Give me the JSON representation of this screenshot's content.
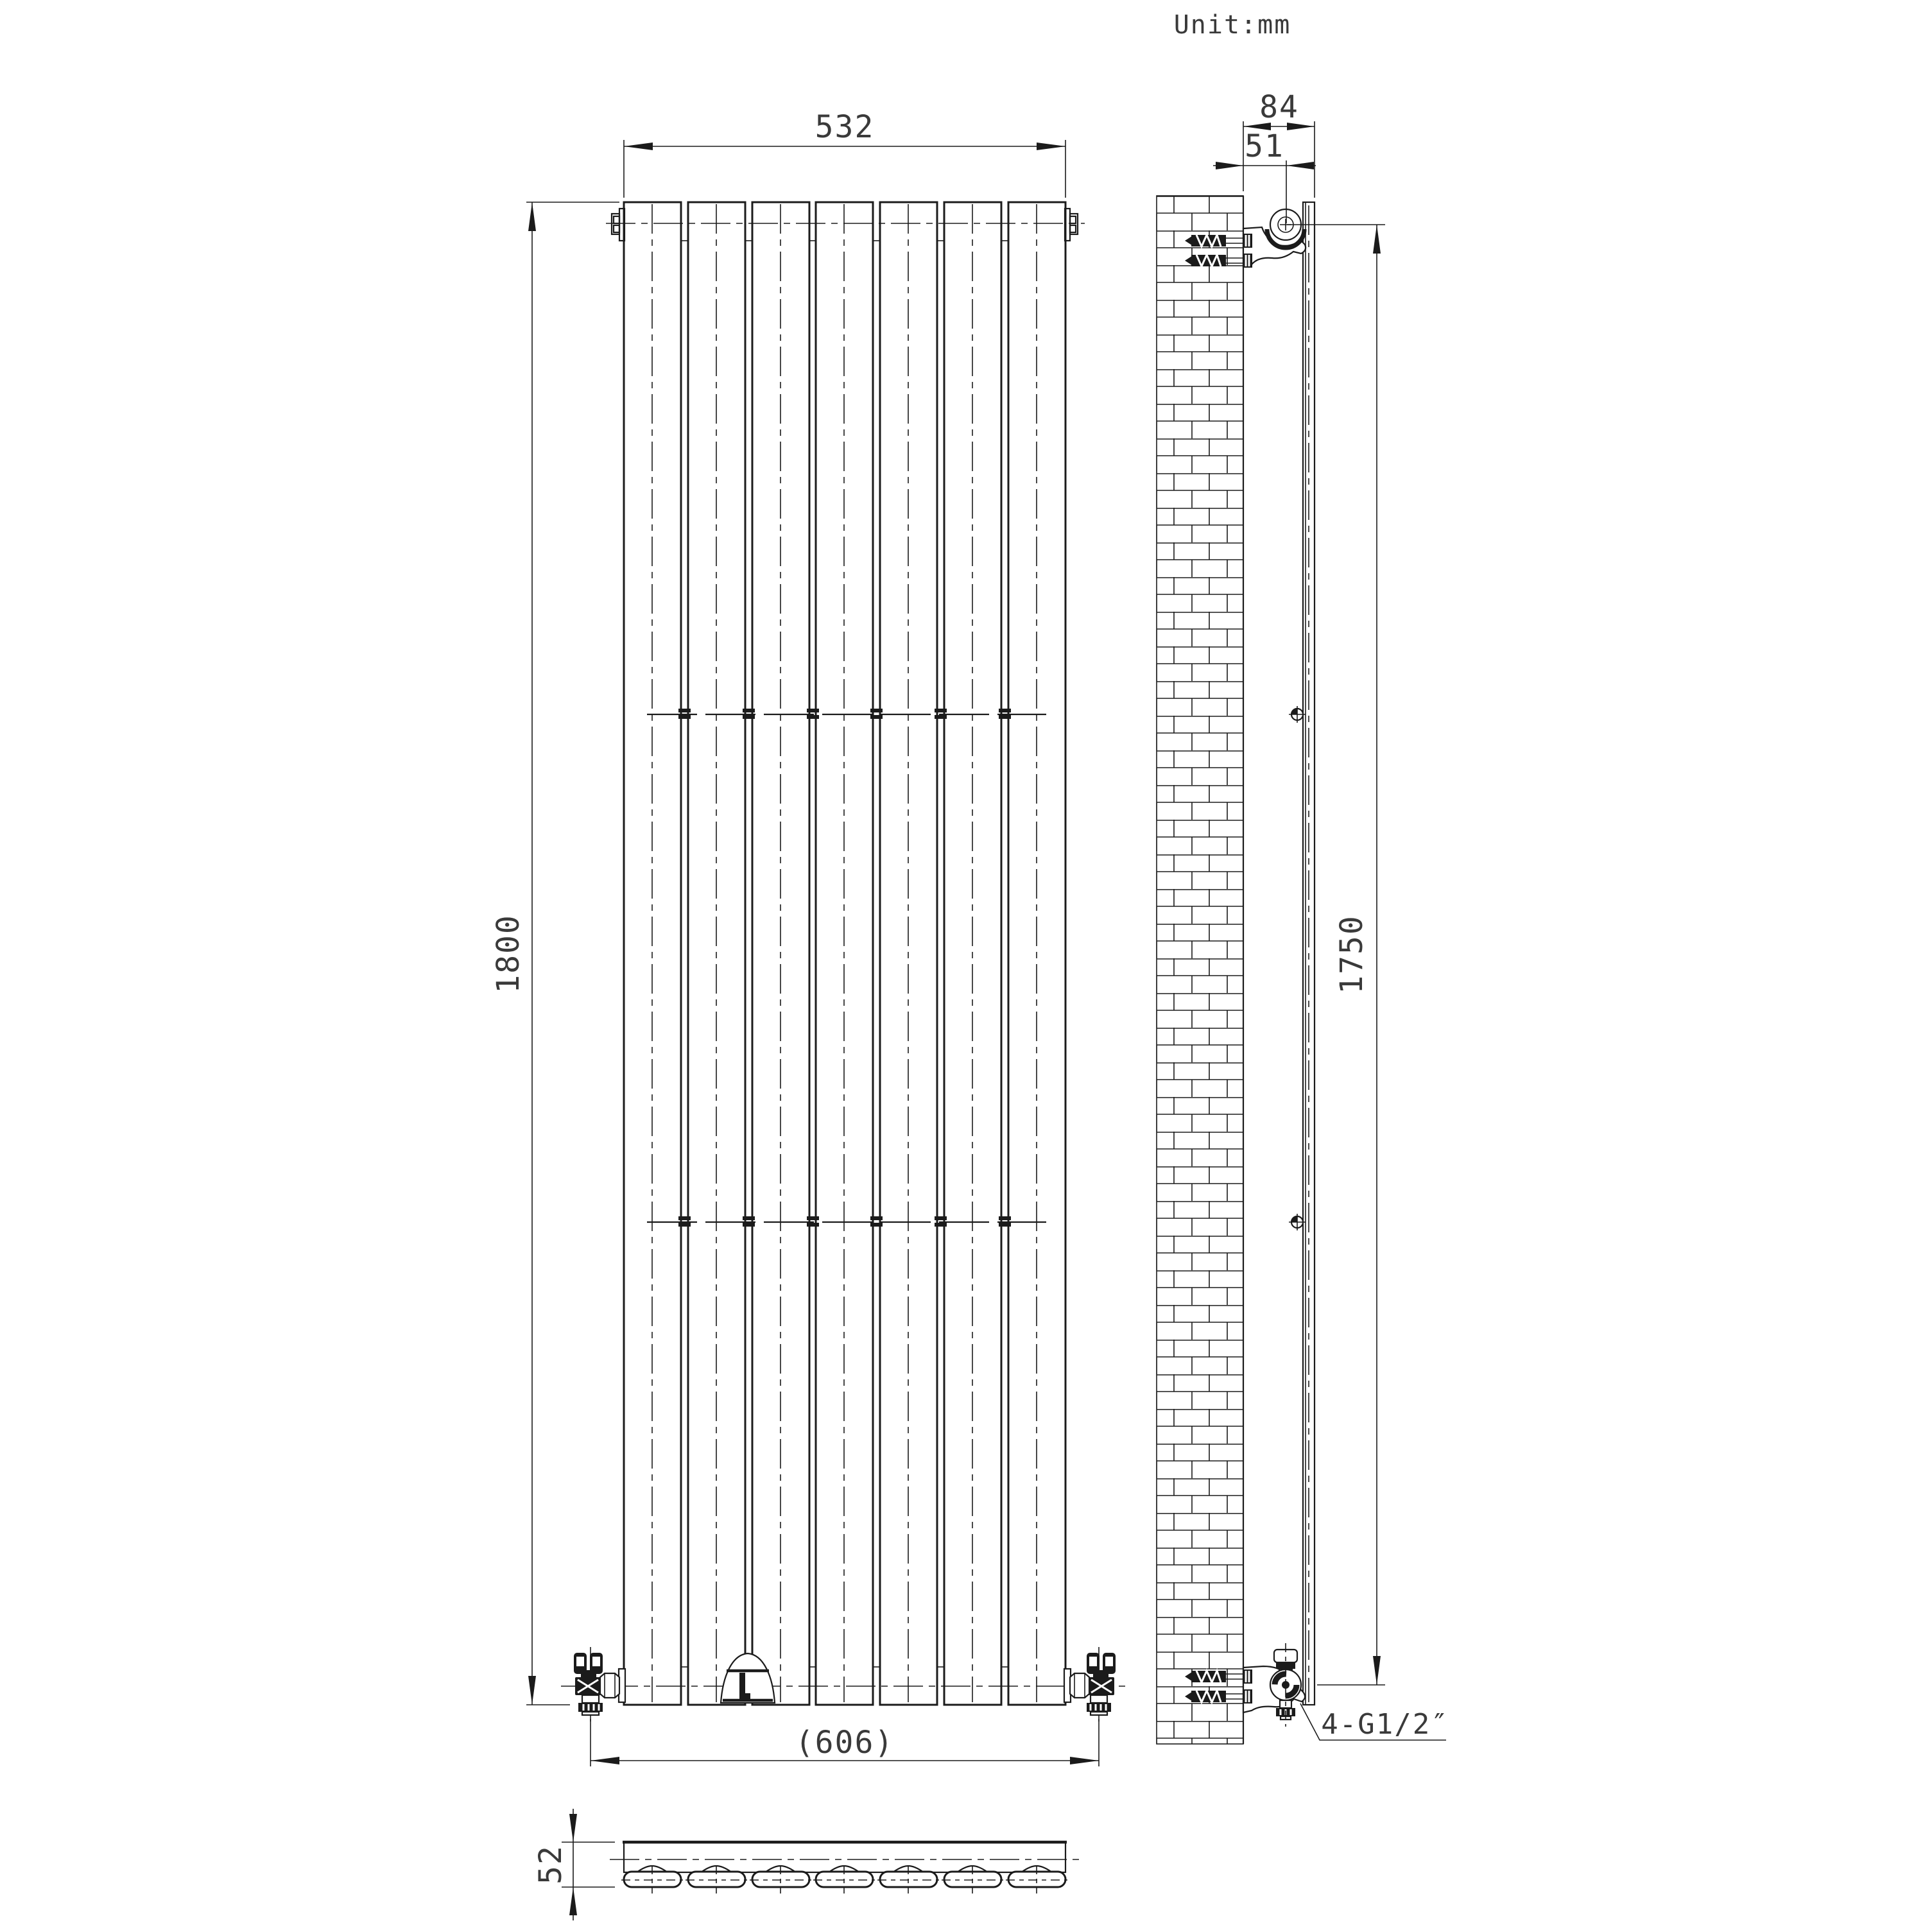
{
  "meta": {
    "unit_note": "Unit:mm"
  },
  "front_view": {
    "width_dim": "532",
    "height_dim": "1800",
    "valve_span_dim": "(606)"
  },
  "side_view": {
    "depth_dim": "84",
    "pipe_offset_dim": "51",
    "mount_height_dim": "1750",
    "thread_label": "4-G1/2″"
  },
  "top_view": {
    "thickness_dim": "52"
  },
  "drawing": {
    "type": "radiator-technical-drawing",
    "panel_count": 7,
    "colors": {
      "line": "#1b1b1b",
      "background": "#ffffff",
      "text": "#3a3a3a"
    }
  }
}
